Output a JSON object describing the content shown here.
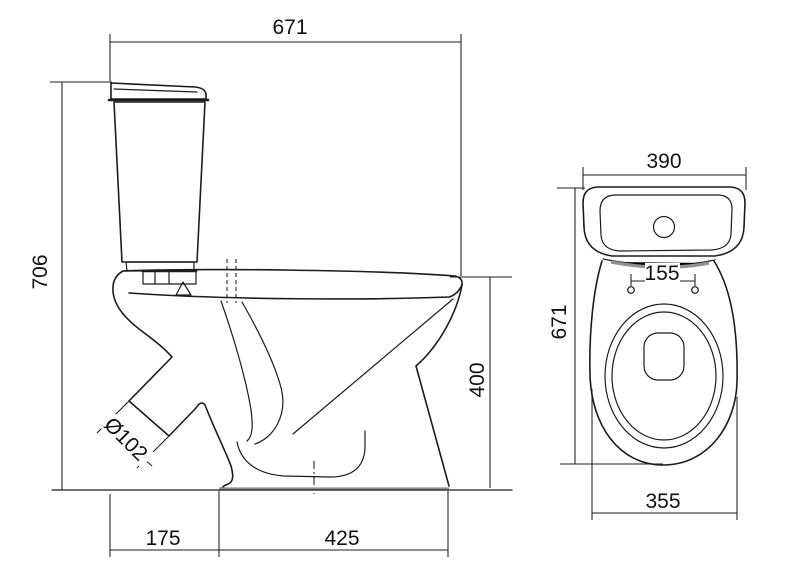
{
  "title": "Toilet technical drawing (side view and top view)",
  "colors": {
    "background": "#ffffff",
    "line": "#1c1c1c",
    "shade": "#909090",
    "text": "#111111"
  },
  "dims": {
    "side_overall_width": "671",
    "side_overall_height": "706",
    "side_bowl_height": "400",
    "side_outlet_diameter": "Ø102",
    "side_back_offset": "175",
    "side_base_length": "425",
    "top_cistern_width": "390",
    "top_hinge_hole_spacing": "155",
    "top_overall_depth": "671",
    "top_bowl_width": "355"
  }
}
